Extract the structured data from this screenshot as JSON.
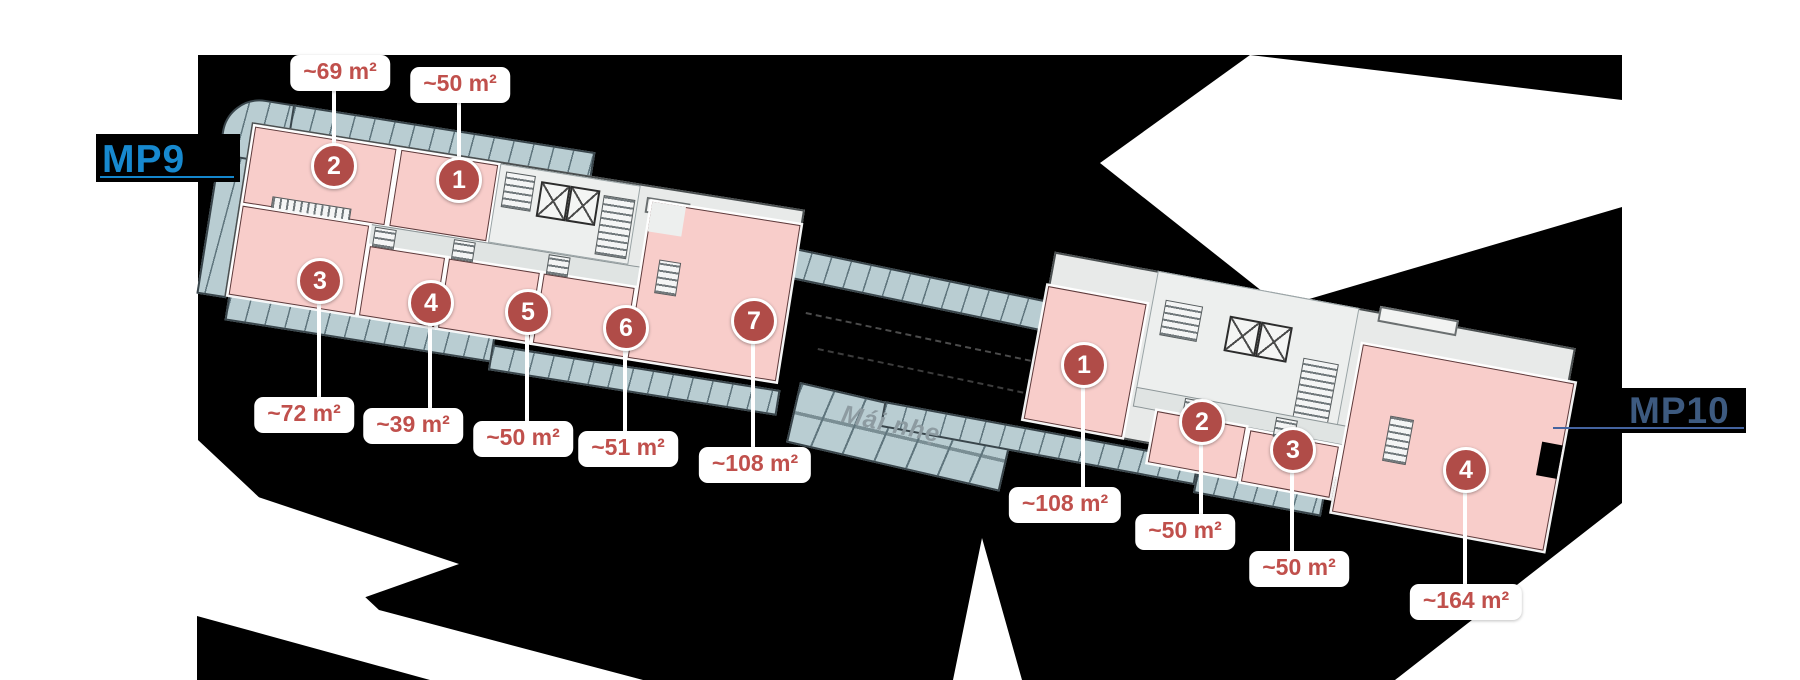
{
  "buildings": [
    {
      "label": "MP9",
      "label_color": "#1789cf",
      "units": [
        {
          "no": "1",
          "area": "~50 m²",
          "circle": {
            "x": 459,
            "y": 180
          },
          "label": {
            "x": 460,
            "y": 85
          },
          "leader": {
            "x": 459,
            "y1": 97,
            "y2": 162
          }
        },
        {
          "no": "2",
          "area": "~69 m²",
          "circle": {
            "x": 334,
            "y": 166
          },
          "label": {
            "x": 340,
            "y": 73
          },
          "leader": {
            "x": 334,
            "y1": 89,
            "y2": 148
          }
        },
        {
          "no": "3",
          "area": "~72 m²",
          "circle": {
            "x": 320,
            "y": 281
          },
          "label": {
            "x": 304,
            "y": 415
          },
          "leader": {
            "x": 319,
            "y1": 300,
            "y2": 400
          }
        },
        {
          "no": "4",
          "area": "~39 m²",
          "circle": {
            "x": 431,
            "y": 303
          },
          "label": {
            "x": 413,
            "y": 426
          },
          "leader": {
            "x": 430,
            "y1": 322,
            "y2": 411
          }
        },
        {
          "no": "5",
          "area": "~50 m²",
          "circle": {
            "x": 528,
            "y": 312
          },
          "label": {
            "x": 523,
            "y": 439
          },
          "leader": {
            "x": 527,
            "y1": 331,
            "y2": 424
          }
        },
        {
          "no": "6",
          "area": "~51 m²",
          "circle": {
            "x": 626,
            "y": 328
          },
          "label": {
            "x": 628,
            "y": 449
          },
          "leader": {
            "x": 625,
            "y1": 347,
            "y2": 434
          }
        },
        {
          "no": "7",
          "area": "~108 m²",
          "circle": {
            "x": 754,
            "y": 321
          },
          "label": {
            "x": 755,
            "y": 465
          },
          "leader": {
            "x": 753,
            "y1": 340,
            "y2": 450
          }
        }
      ]
    },
    {
      "label": "MP10",
      "label_color": "#3d5a80",
      "units": [
        {
          "no": "1",
          "area": "~108 m²",
          "circle": {
            "x": 1084,
            "y": 365
          },
          "label": {
            "x": 1065,
            "y": 505
          },
          "leader": {
            "x": 1083,
            "y1": 386,
            "y2": 490
          }
        },
        {
          "no": "2",
          "area": "~50 m²",
          "circle": {
            "x": 1202,
            "y": 422
          },
          "label": {
            "x": 1185,
            "y": 532
          },
          "leader": {
            "x": 1201,
            "y1": 443,
            "y2": 517
          }
        },
        {
          "no": "3",
          "area": "~50 m²",
          "circle": {
            "x": 1293,
            "y": 450
          },
          "label": {
            "x": 1299,
            "y": 569
          },
          "leader": {
            "x": 1292,
            "y1": 471,
            "y2": 555
          }
        },
        {
          "no": "4",
          "area": "~164 m²",
          "circle": {
            "x": 1466,
            "y": 470
          },
          "label": {
            "x": 1466,
            "y": 602
          },
          "leader": {
            "x": 1465,
            "y1": 491,
            "y2": 587
          }
        }
      ]
    }
  ],
  "annotations": {
    "mai_nhe": "Mái nhẹ"
  },
  "colors": {
    "marker": "#b04c48",
    "area_text": "#c0504c",
    "mp9": "#1789cf",
    "mp9_underline": "#1486cc",
    "mp10": "#3d5a80",
    "mp10_underline": "#44639f",
    "unit_fill": "#f8cdca",
    "balcony": "#b9cdd2",
    "core": "#e8eae9",
    "backdrop": "#000000",
    "cutout": "#ffffff"
  }
}
